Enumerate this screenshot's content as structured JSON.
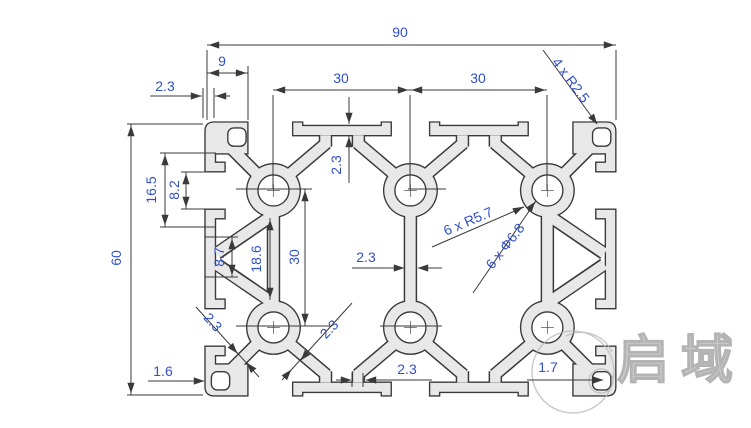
{
  "drawing": {
    "dims": {
      "total_width": "90",
      "total_height": "60",
      "corner_width": "9",
      "wall_top_left": "2.3",
      "slot_pitch_1": "30",
      "slot_pitch_2": "30",
      "corner_radius": "4 x R2.5",
      "side_slot_inner": "16.5",
      "side_slot_opening": "8.2",
      "mid_lip_gap": "8.7",
      "boss_gap": "18.6",
      "hole_pitch_v": "30",
      "flange_thickness": "2.3",
      "center_web": "2.3",
      "boss_radius": "6 x R5.7",
      "hole_diameter": "6 x Φ6.8",
      "diag_wall_left": "2.3",
      "diag_wall_right": "2.3",
      "corner_wall_left": "1.6",
      "bottom_web": "2.3",
      "corner_wall_right": "1.7"
    },
    "watermark": {
      "text": "启域"
    },
    "colors": {
      "profile_fill": "#e8e8e8",
      "outline": "#3a3a3a",
      "dim_text": "#3050c8",
      "watermark_gray": "#b8b8b8"
    }
  }
}
